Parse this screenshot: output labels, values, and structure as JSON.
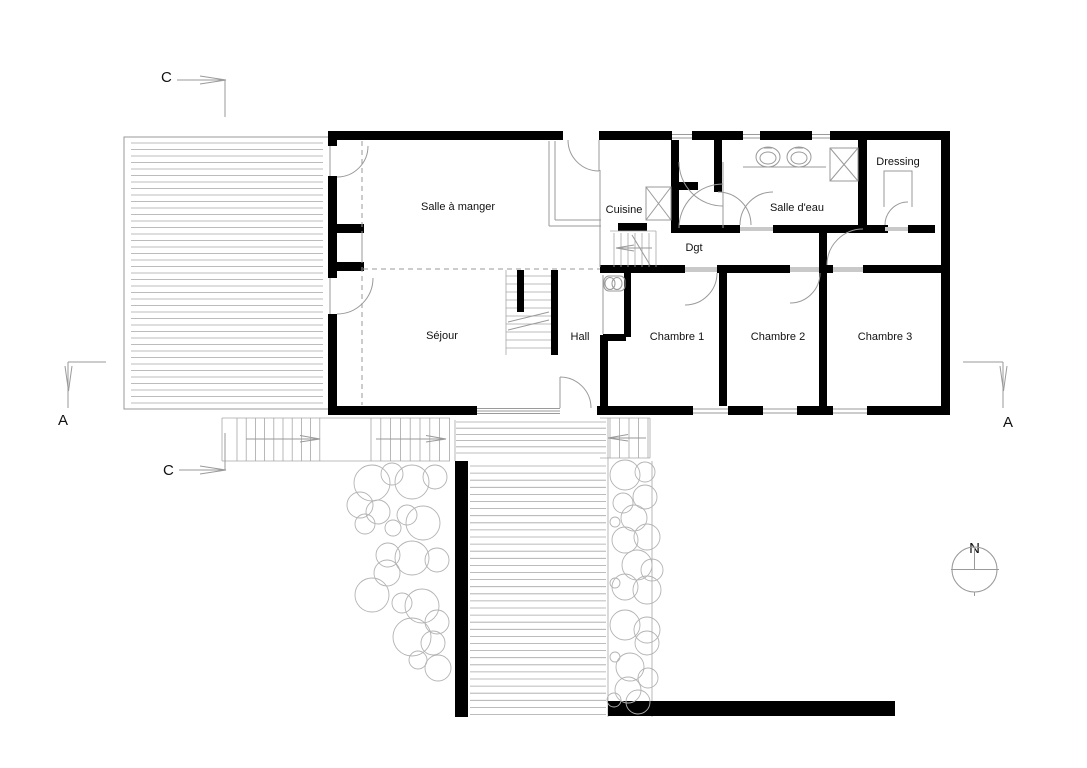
{
  "plan": {
    "rooms": {
      "dining": "Salle à manger",
      "kitchen": "Cuisine",
      "living": "Séjour",
      "hall": "Hall",
      "corridor": "Dgt",
      "bathroom": "Salle d'eau",
      "dressing": "Dressing",
      "bedroom1": "Chambre 1",
      "bedroom2": "Chambre 2",
      "bedroom3": "Chambre 3"
    },
    "section_markers": {
      "c_top": "C",
      "c_bottom": "C",
      "a_left": "A",
      "a_right": "A"
    },
    "compass": {
      "north_label": "N"
    },
    "colors": {
      "wall": "#000000",
      "line_gray": "#9a9a9a",
      "light_gray": "#c9c9c9",
      "background": "#ffffff"
    }
  }
}
